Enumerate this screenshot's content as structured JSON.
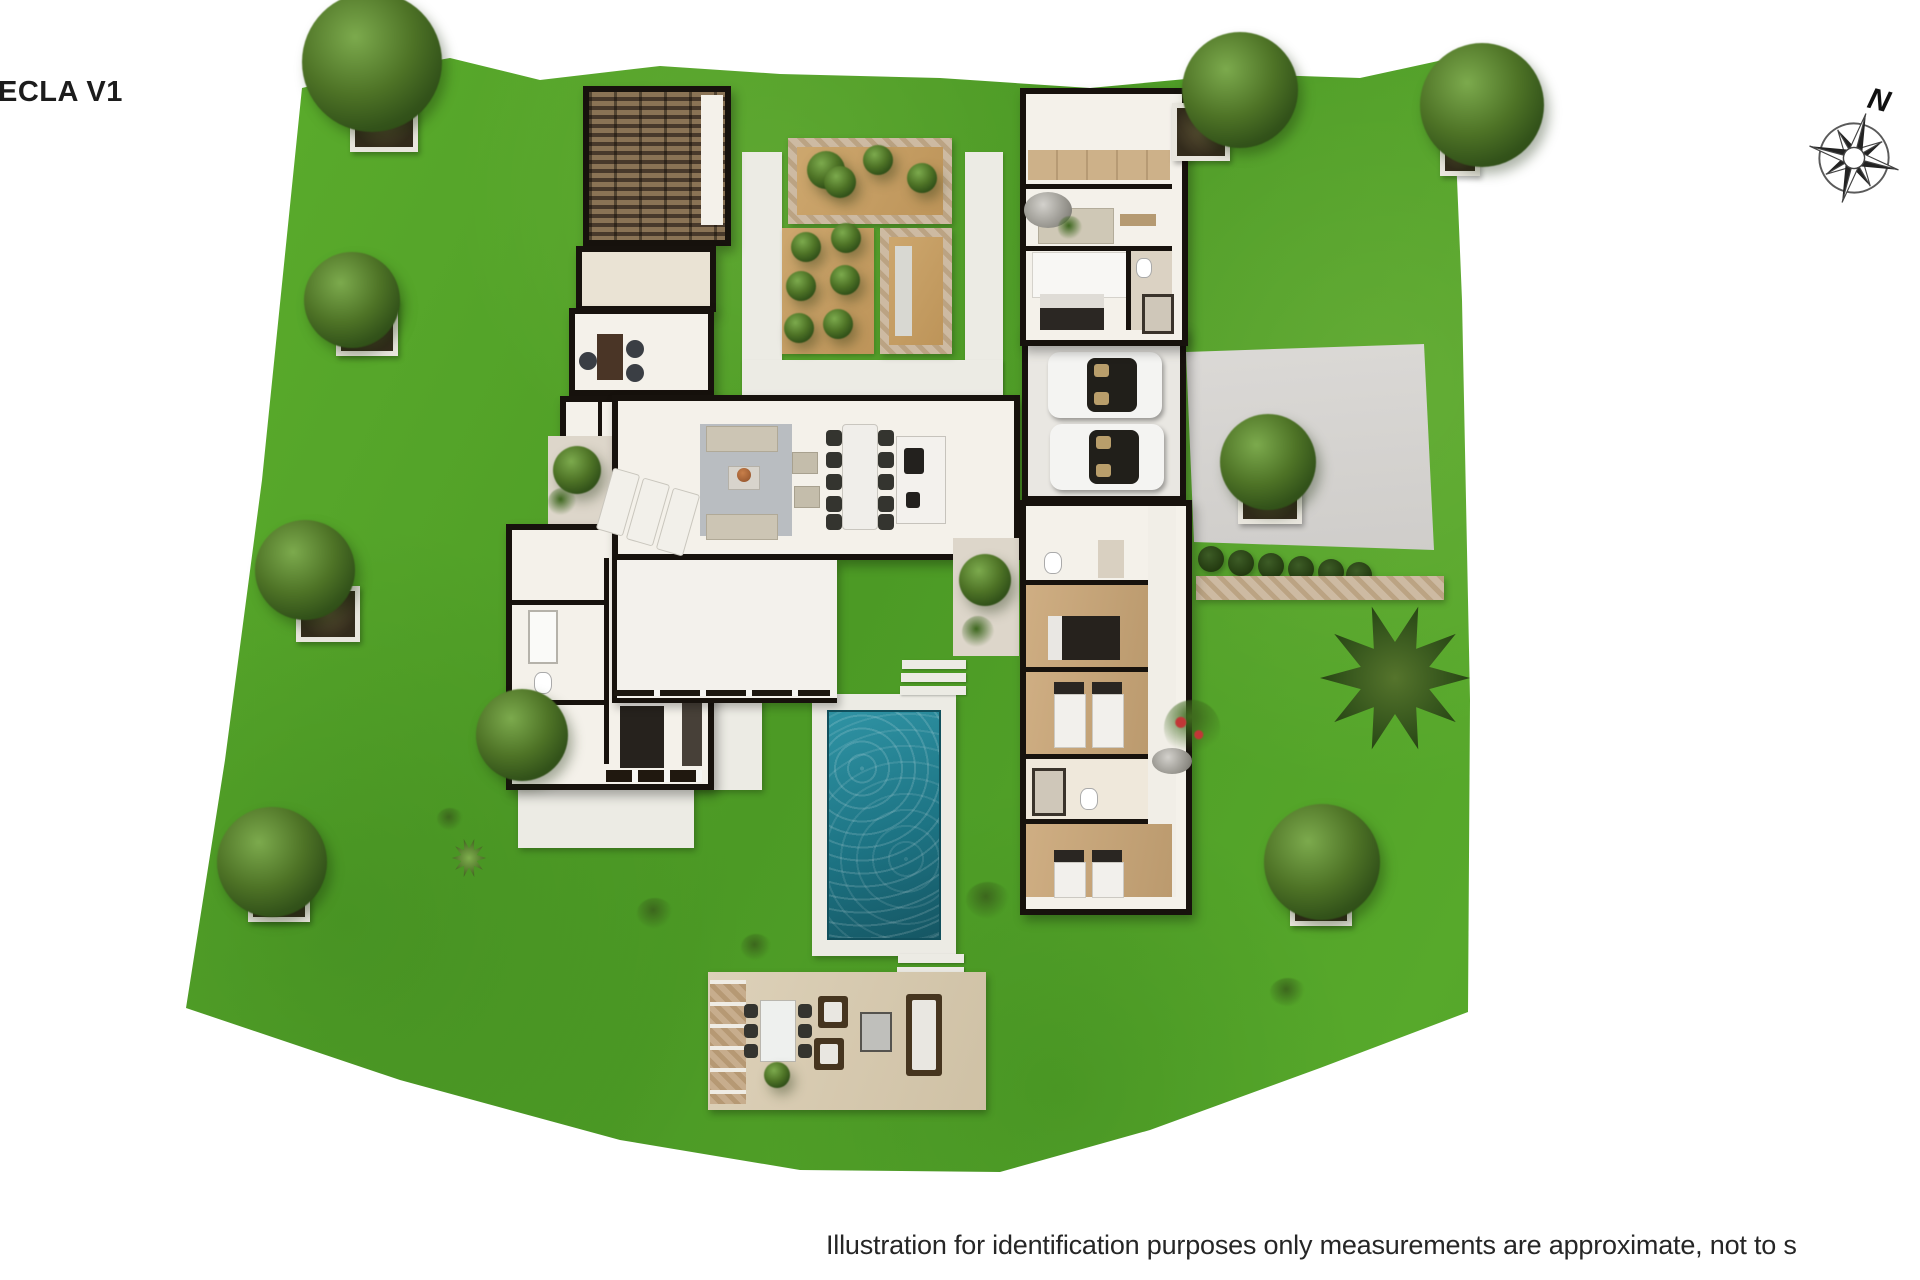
{
  "title": "ECLA V1",
  "compass": {
    "label": "N",
    "icon": "compass-rose-icon"
  },
  "footer": {
    "text": "Illustration for identification purposes only measurements are approximate, not to s"
  },
  "plan": {
    "type": "villa-floor-plan-3d-top-view",
    "features": [
      "wine-cellar-pergola-room",
      "storage-room",
      "office",
      "central-courtyard-planters",
      "olive-grove",
      "living-room",
      "dining-table",
      "kitchen-island",
      "double-garage-two-cars",
      "driveway",
      "hedge-row",
      "master-suite",
      "bathrooms",
      "bedroom-double",
      "bedroom-twin",
      "guest-bedroom",
      "swimming-pool",
      "sun-loungers",
      "outdoor-lounge-terrace",
      "stepping-stones",
      "garden-trees",
      "palm-tree"
    ]
  },
  "theme": {
    "bg": "#ffffff",
    "ink": "#1c1c1c",
    "grassA": "#5fb12e",
    "grassB": "#4c9a25",
    "wall": "#17120d",
    "floor": "#f4f1ea",
    "cream": "#eae3d4",
    "slatA": "#8a7355",
    "slatB": "#48392b",
    "stoneA": "#cdbaa2",
    "stoneB": "#bba383",
    "sand": "#c59e66",
    "poolA": "#2f93a4",
    "poolB": "#155663",
    "deck": "#ecebe4",
    "drive": "#d6d4d1",
    "rug": "#b9bdc1",
    "wood": "#c6a77d",
    "hedge": "#2e4a1c",
    "terrace": "#d9ccb2",
    "soil": "#b3b3b1",
    "car": "#f4f4f2",
    "cushion": "#e9e7e1"
  }
}
